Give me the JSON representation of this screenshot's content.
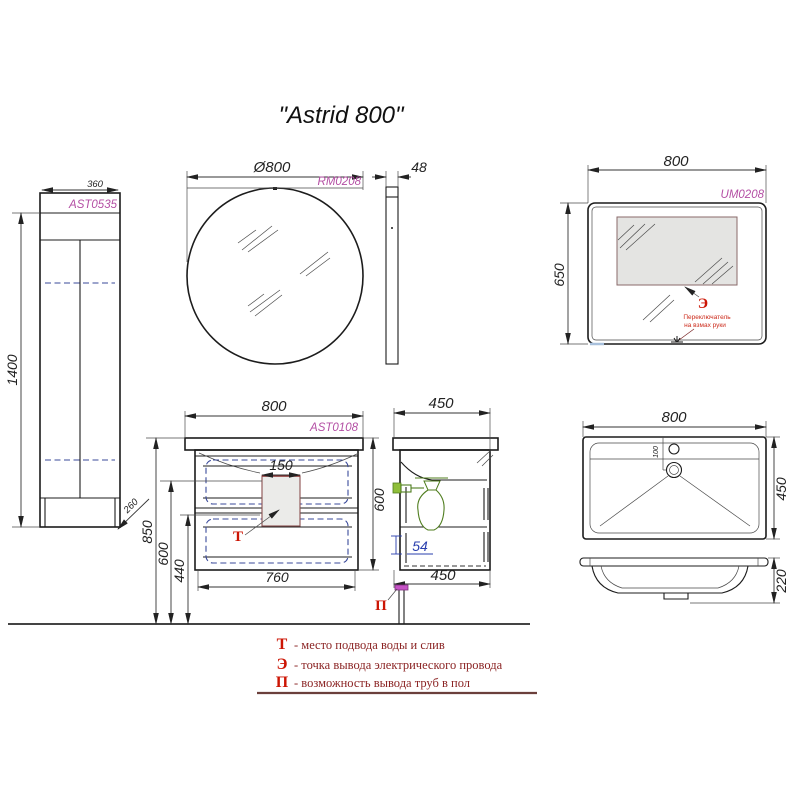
{
  "title": "\"Astrid 800\"",
  "colors": {
    "line": "#1c1c1c",
    "code_accent": "#b44fa4",
    "marker_red": "#cc1504",
    "legend_text": "#8b2424",
    "dashed_blue": "#3a4a9a",
    "siphon_green": "#4f7d1e",
    "panel_gray": "#e4e4e2"
  },
  "tall_cabinet": {
    "code": "AST0535",
    "width": "360",
    "height": "1400",
    "depth": "260"
  },
  "round_mirror": {
    "code": "RM0208",
    "diameter": "Ø800",
    "thickness": "48"
  },
  "rect_mirror": {
    "code": "UM0208",
    "width": "800",
    "height": "650",
    "marker": "Э",
    "note_line1": "Переключатель",
    "note_line2": "на взмах руки"
  },
  "vanity": {
    "code": "AST0108",
    "width": "800",
    "cutout_width": "150",
    "bottom_width": "760",
    "box_height": "600",
    "height_to_top": "850",
    "height_mid": "600",
    "height_low": "440",
    "marker": "Т"
  },
  "vanity_side": {
    "depth_top": "450",
    "depth_bottom": "450",
    "clearance": "54",
    "marker": "П"
  },
  "sink": {
    "width": "800",
    "depth": "450",
    "bowl_height": "220",
    "drain_offset": "100"
  },
  "legend": {
    "rows": [
      {
        "symbol": "Т",
        "text": "- место подвода воды и слив"
      },
      {
        "symbol": "Э",
        "text": "- точка вывода электрического провода"
      },
      {
        "symbol": "П",
        "text": "- возможность вывода труб в пол"
      }
    ]
  }
}
